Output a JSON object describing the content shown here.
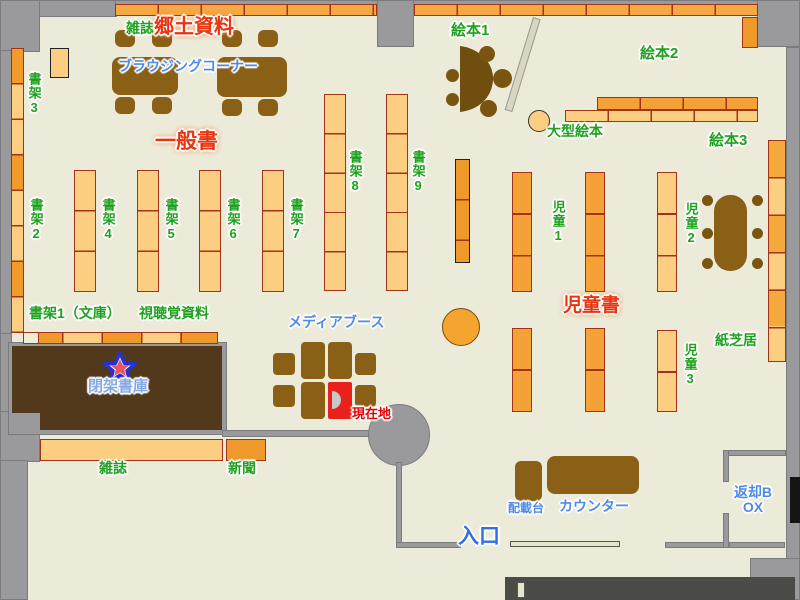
{
  "map_title": "library-floor-map",
  "labels": {
    "magazines_top": "雑誌",
    "local_materials": "郷土資料",
    "browsing_corner": "ブラウジングコーナー",
    "shelf3": "書架3",
    "general_books": "一般書",
    "shelf2": "書架2",
    "shelf4": "書架4",
    "shelf5": "書架5",
    "shelf6": "書架6",
    "shelf7": "書架7",
    "shelf8": "書架8",
    "shelf9": "書架9",
    "picture_books1": "絵本1",
    "picture_books2": "絵本2",
    "picture_books3": "絵本3",
    "large_picture_books": "大型絵本",
    "children1": "児童1",
    "children2": "児童2",
    "children3": "児童3",
    "childrens_books": "児童書",
    "kamishibai": "紙芝居",
    "shelf1_bunko": "書架1（文庫）",
    "av_materials": "視聴覚資料",
    "media_booth": "メディアブース",
    "closed_stacks": "閉架書庫",
    "current_location": "現在地",
    "magazines_bottom": "雑誌",
    "newspapers": "新聞",
    "loading_stand": "配載台",
    "counter": "カウンター",
    "return_box": "返却BOX",
    "entrance": "入口"
  },
  "colors": {
    "background": "#ECEBD9",
    "wall_gray": "#9A9A9C",
    "shelf_light": "#FBCE82",
    "shelf_medium": "#F4A238",
    "shelf_dark": "#F0992B",
    "shelf_border": "#A03318",
    "furniture_brown": "#8A6017",
    "stool_brown": "#7A5510",
    "closed_stacks_brown": "#53391B",
    "label_green": "#1FA11F",
    "label_red": "#E93410",
    "label_blue": "#4E8BE8",
    "label_lightblue": "#85A9E6",
    "current_location_red": "#E60000",
    "current_cell_red": "#E8211D"
  },
  "marker": {
    "star": "★"
  }
}
